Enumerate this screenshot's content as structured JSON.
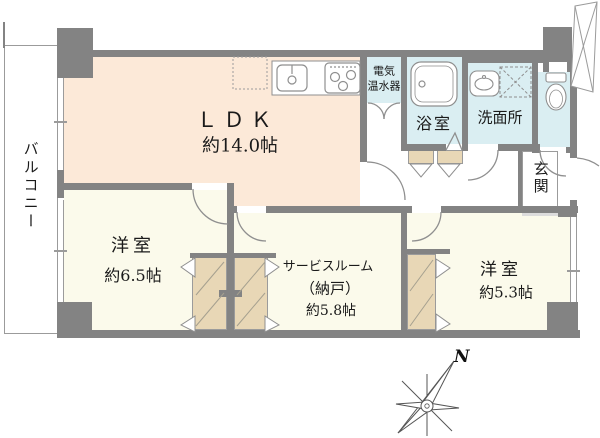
{
  "plan_title": "マンション間取り図",
  "rooms": {
    "balcony": {
      "label": "バルコニー"
    },
    "ldk": {
      "label": "ＬＤＫ",
      "size": "約14.0帖"
    },
    "water_heater": {
      "label_line1": "電気",
      "label_line2": "温水器"
    },
    "bathroom": {
      "label": "浴室"
    },
    "washroom": {
      "label": "洗面所"
    },
    "entrance": {
      "label": "玄関"
    },
    "bedroom_65": {
      "label": "洋室",
      "size": "約6.5帖"
    },
    "service_room": {
      "label": "サービスルーム",
      "label2": "（納戸）",
      "size": "約5.8帖"
    },
    "bedroom_53": {
      "label": "洋室",
      "size": "約5.3帖"
    }
  },
  "compass": {
    "label": "N"
  },
  "colors": {
    "wall": "#838383",
    "ldk": "#fce9d8",
    "room": "#fbfaeb",
    "wet": "#daeef2",
    "closet": "#e8d7b6",
    "line": "#9b9b9b",
    "step": "#dcdcdc",
    "text": "#1a1a1a"
  }
}
